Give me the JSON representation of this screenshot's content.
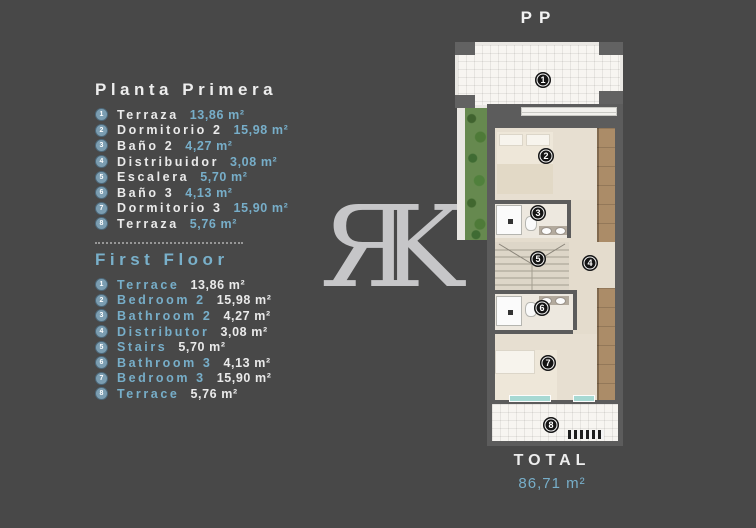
{
  "colors": {
    "background": "#484848",
    "accent_blue": "#77aec9",
    "text_white": "#eaeaea",
    "wall_gray": "#5c5c5c",
    "wood_brown": "#ab8c68",
    "glass_teal": "#a7d9d3",
    "watermark_gray": "#c6c6c8"
  },
  "watermark": {
    "letter_r": "Я",
    "letter_k": "K"
  },
  "plan": {
    "label": "PP",
    "badges": [
      "1",
      "2",
      "3",
      "4",
      "5",
      "6",
      "7",
      "8"
    ],
    "total": {
      "label": "TOTAL",
      "value": "86,71 m²"
    }
  },
  "legend_es": {
    "title": "Planta Primera",
    "items": [
      {
        "num": "1",
        "name": "Terraza",
        "area": "13,86 m²"
      },
      {
        "num": "2",
        "name": "Dormitorio 2",
        "area": "15,98 m²"
      },
      {
        "num": "3",
        "name": "Baño 2",
        "area": "4,27 m²"
      },
      {
        "num": "4",
        "name": "Distribuidor",
        "area": "3,08 m²"
      },
      {
        "num": "5",
        "name": "Escalera",
        "area": "5,70 m²"
      },
      {
        "num": "6",
        "name": "Baño 3",
        "area": "4,13 m²"
      },
      {
        "num": "7",
        "name": "Dormitorio 3",
        "area": "15,90 m²"
      },
      {
        "num": "8",
        "name": "Terraza",
        "area": "5,76 m²"
      }
    ]
  },
  "legend_en": {
    "title": "First Floor",
    "items": [
      {
        "num": "1",
        "name": "Terrace",
        "area": "13,86 m²"
      },
      {
        "num": "2",
        "name": "Bedroom 2",
        "area": "15,98 m²"
      },
      {
        "num": "3",
        "name": "Bathroom 2",
        "area": "4,27 m²"
      },
      {
        "num": "4",
        "name": "Distributor",
        "area": "3,08 m²"
      },
      {
        "num": "5",
        "name": "Stairs",
        "area": "5,70 m²"
      },
      {
        "num": "6",
        "name": "Bathroom 3",
        "area": "4,13 m²"
      },
      {
        "num": "7",
        "name": "Bedroom 3",
        "area": "15,90 m²"
      },
      {
        "num": "8",
        "name": "Terrace",
        "area": "5,76 m²"
      }
    ]
  }
}
